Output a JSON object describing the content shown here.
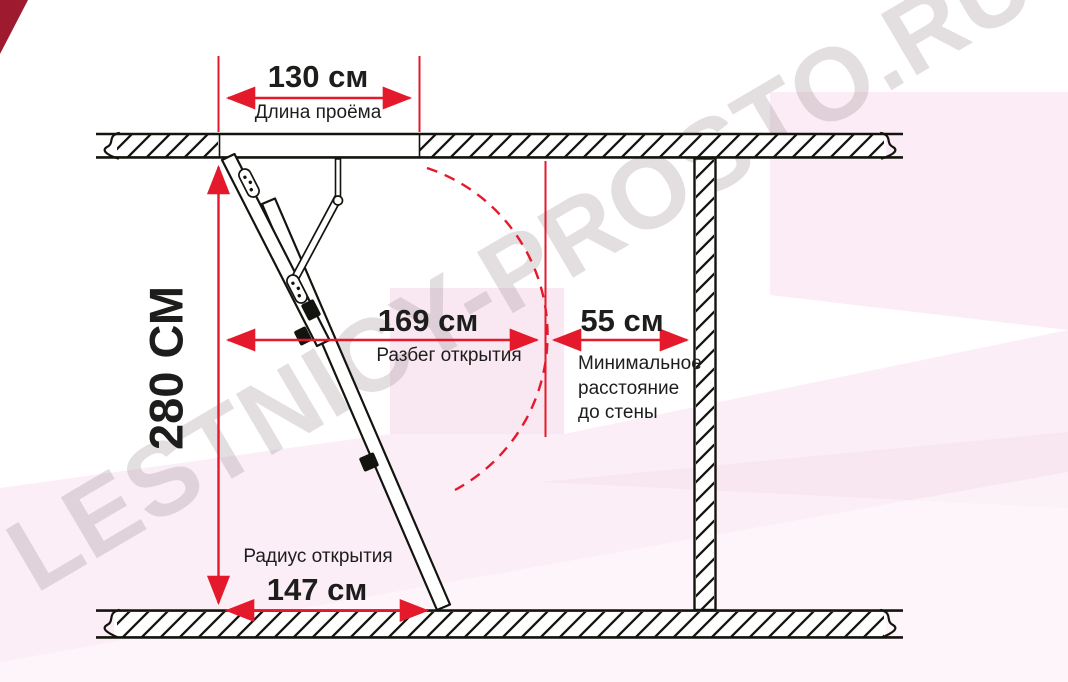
{
  "diagram": {
    "watermark": "LESTNICY-PROSTO.RU",
    "colors": {
      "dimension_red": "#e4192b",
      "line_black": "#14140f",
      "text_black": "#1d1d1b",
      "pink_band": "#f9e8f2",
      "pink_area": "#fbeef6",
      "corner_red": "#9e1b2f"
    },
    "dimensions": {
      "opening_length": {
        "value": "130 см",
        "label": "Длина проёма"
      },
      "room_height": {
        "value": "280 СМ"
      },
      "opening_run": {
        "value": "169 см",
        "label": "Разбег открытия"
      },
      "wall_clearance": {
        "value": "55 см",
        "label": "Минимальное\nрасстояние\nдо стены"
      },
      "opening_radius": {
        "value": "147 см",
        "label": "Радиус открытия"
      }
    }
  }
}
